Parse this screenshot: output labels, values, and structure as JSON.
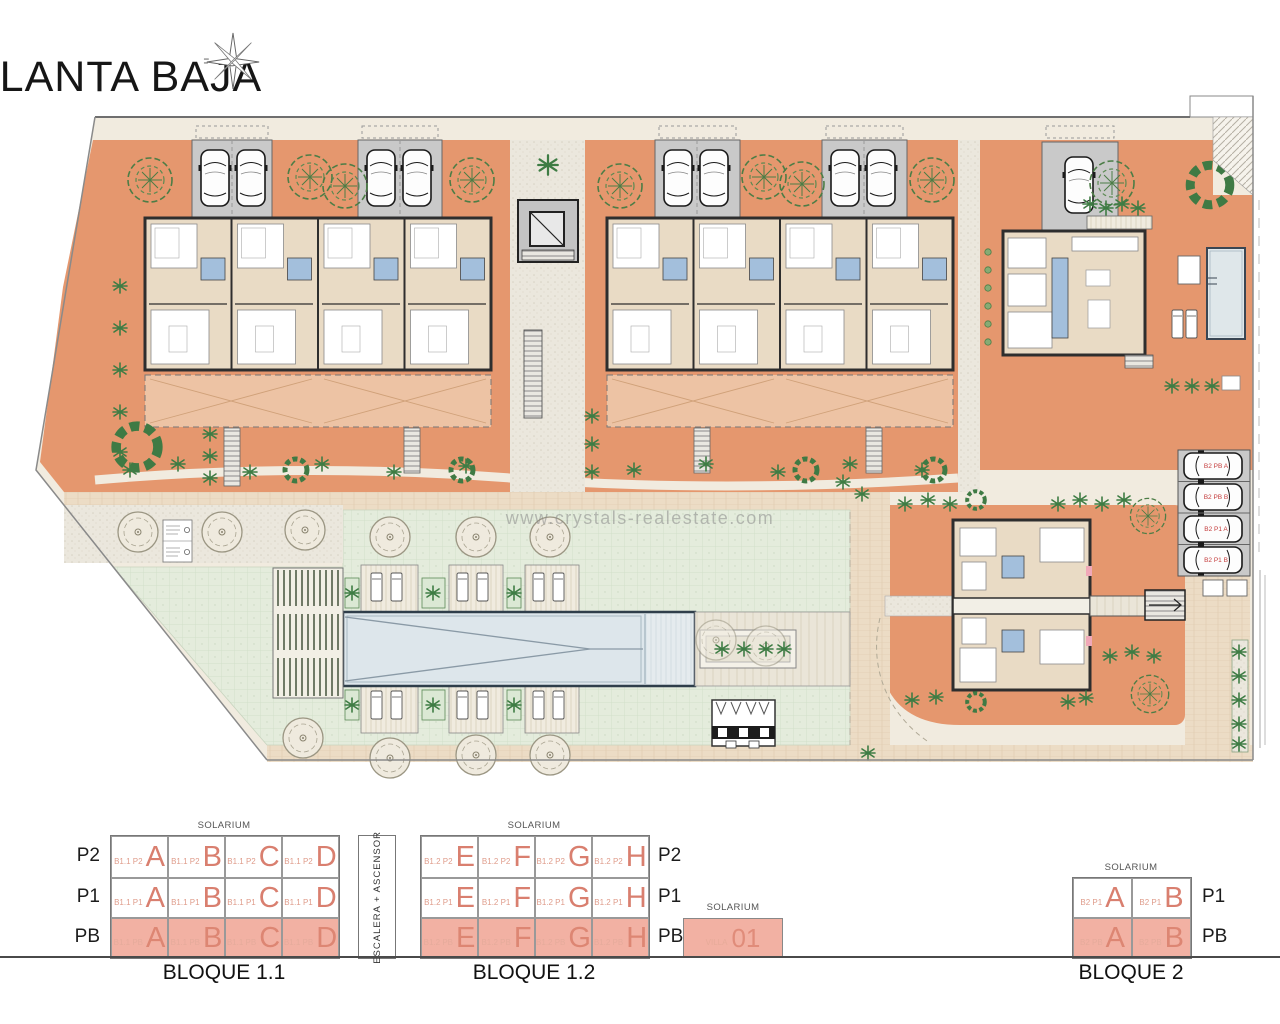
{
  "title": "PLANTA BAJA",
  "watermark": "www.crystals-realestate.com",
  "plan": {
    "parking_labels": [
      "B2 PB A",
      "B2 PB B",
      "B2 P1 A",
      "B2 P1 B"
    ]
  },
  "schematic": {
    "escalera": "ESCALERA + ASCENSOR",
    "blocks": {
      "b11": {
        "caption": "BLOQUE 1.1",
        "solarium": "SOLARIUM",
        "row_labels": [
          "P2",
          "P1",
          "PB"
        ],
        "rows": [
          {
            "cells": [
              {
                "code": "B1.1 P2",
                "letter": "A"
              },
              {
                "code": "B1.1 P2",
                "letter": "B"
              },
              {
                "code": "B1.1 P2",
                "letter": "C"
              },
              {
                "code": "B1.1 P2",
                "letter": "D"
              }
            ]
          },
          {
            "cells": [
              {
                "code": "B1.1 P1",
                "letter": "A"
              },
              {
                "code": "B1.1 P1",
                "letter": "B"
              },
              {
                "code": "B1.1 P1",
                "letter": "C"
              },
              {
                "code": "B1.1 P1",
                "letter": "D"
              }
            ]
          },
          {
            "cells": [
              {
                "code": "B1.1 PB",
                "letter": "A"
              },
              {
                "code": "B1.1 PB",
                "letter": "B"
              },
              {
                "code": "B1.1 PB",
                "letter": "C"
              },
              {
                "code": "B1.1 PB",
                "letter": "D"
              }
            ]
          }
        ]
      },
      "b12": {
        "caption": "BLOQUE 1.2",
        "solarium": "SOLARIUM",
        "row_labels": [
          "P2",
          "P1",
          "PB"
        ],
        "rows": [
          {
            "cells": [
              {
                "code": "B1.2 P2",
                "letter": "E"
              },
              {
                "code": "B1.2 P2",
                "letter": "F"
              },
              {
                "code": "B1.2 P2",
                "letter": "G"
              },
              {
                "code": "B1.2 P2",
                "letter": "H"
              }
            ]
          },
          {
            "cells": [
              {
                "code": "B1.2 P1",
                "letter": "E"
              },
              {
                "code": "B1.2 P1",
                "letter": "F"
              },
              {
                "code": "B1.2 P1",
                "letter": "G"
              },
              {
                "code": "B1.2 P1",
                "letter": "H"
              }
            ]
          },
          {
            "cells": [
              {
                "code": "B1.2 PB",
                "letter": "E"
              },
              {
                "code": "B1.2 PB",
                "letter": "F"
              },
              {
                "code": "B1.2 PB",
                "letter": "G"
              },
              {
                "code": "B1.2 PB",
                "letter": "H"
              }
            ]
          }
        ]
      },
      "villa": {
        "solarium": "SOLARIUM",
        "name": "VILLA",
        "number": "01"
      },
      "b2": {
        "caption": "BLOQUE 2",
        "solarium": "SOLARIUM",
        "row_labels": [
          "P1",
          "PB"
        ],
        "rows": [
          {
            "cells": [
              {
                "code": "B2 P1",
                "letter": "A"
              },
              {
                "code": "B2 P1",
                "letter": "B"
              }
            ]
          },
          {
            "cells": [
              {
                "code": "B2 PB",
                "letter": "A"
              },
              {
                "code": "B2 PB",
                "letter": "B"
              }
            ]
          }
        ]
      }
    }
  }
}
